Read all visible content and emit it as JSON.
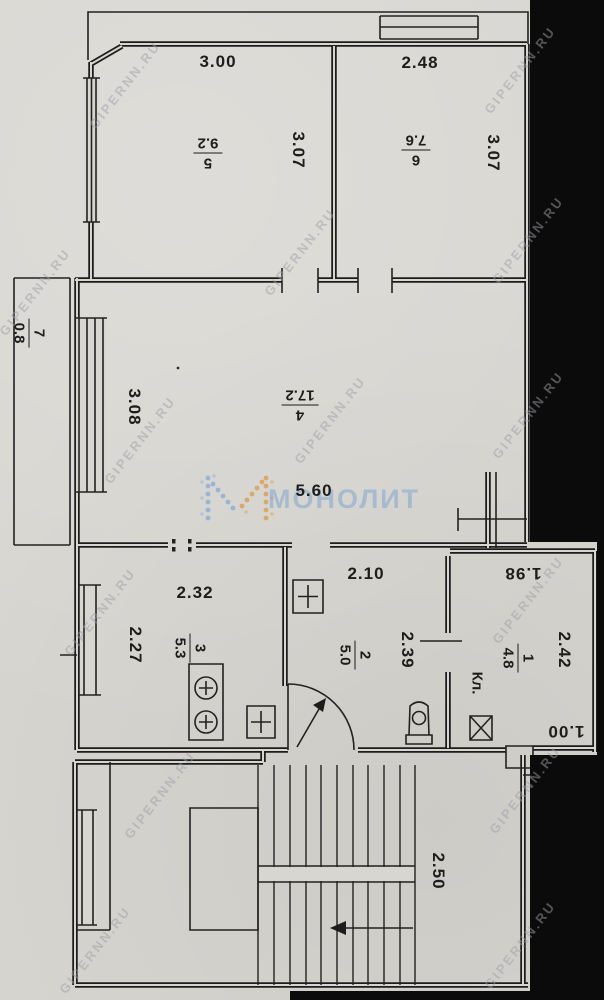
{
  "document": {
    "type_label": "apartment floor plan (scanned)"
  },
  "watermark": {
    "tile_text": "GIPERNN.RU",
    "logo_text": "МОНОЛИТ",
    "logo_dot_colors": {
      "blue": "#8fb0d8",
      "orange": "#dba05a"
    }
  },
  "rooms": [
    {
      "number": "5",
      "area": "9.2"
    },
    {
      "number": "6",
      "area": "7.6"
    },
    {
      "number": "7",
      "area": "0.8"
    },
    {
      "number": "4",
      "area": "17.2"
    },
    {
      "number": "3",
      "area": "5.3"
    },
    {
      "number": "2",
      "area": "5.0"
    },
    {
      "number": "1",
      "area": "4.8",
      "name": "Кл."
    }
  ],
  "dims": {
    "w5": "3.00",
    "w6": "2.48",
    "d5": "3.07",
    "d6": "3.07",
    "d4": "3.08",
    "w4": "5.60",
    "w3": "2.32",
    "d3": "2.27",
    "w2": "2.10",
    "d2": "2.39",
    "w1": "1.98",
    "d1": "2.42",
    "door1": "1.00",
    "stair": "2.50"
  },
  "colors": {
    "paper": "#d8d6d1",
    "ink": "#1d1d1b",
    "scan_edge": "#0b0b0b"
  }
}
